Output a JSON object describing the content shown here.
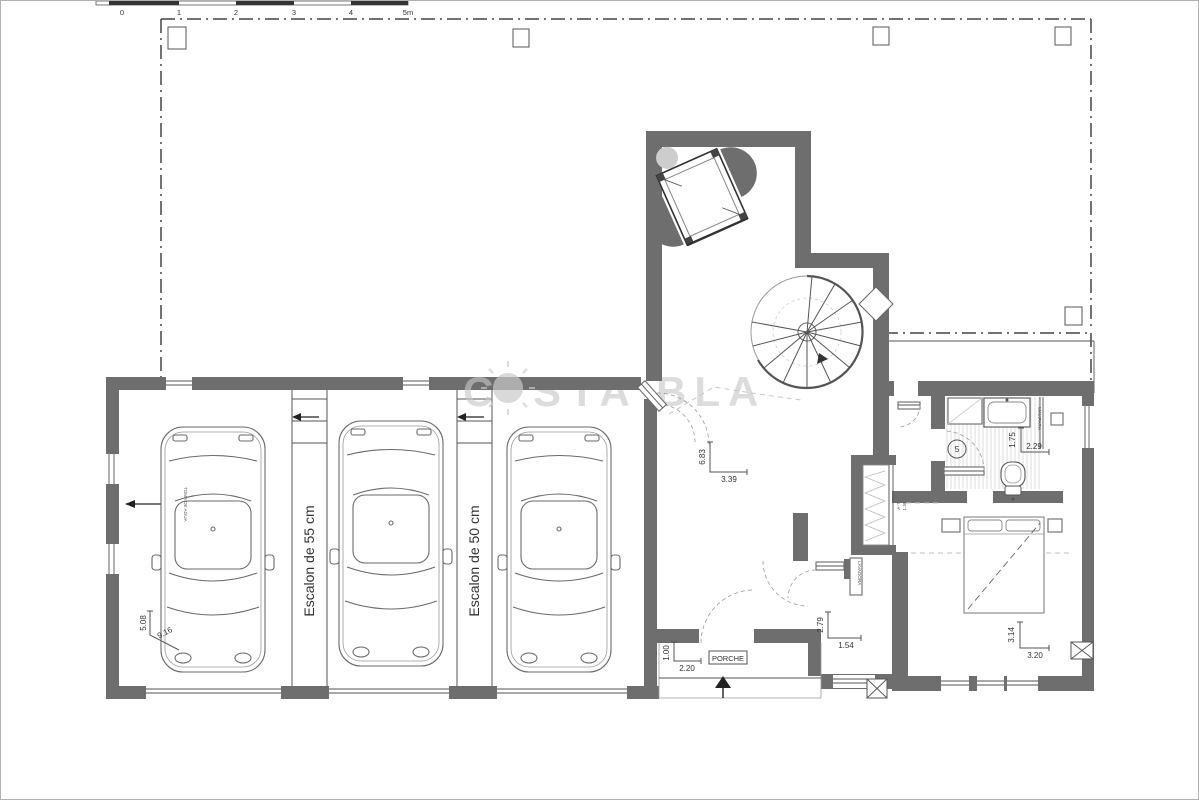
{
  "scale_bar": {
    "ticks": [
      "0",
      "1",
      "2",
      "3",
      "4",
      "5m"
    ]
  },
  "watermark": {
    "prefix": "C",
    "suffix": "STA BLA"
  },
  "labels": {
    "step_55": "Escalon de 55 cm",
    "step_50": "Escalon de 50 cm",
    "water_supply": "TOMA DE AGUA",
    "porch": "PORCHE",
    "shower_screen": "MAMPARA",
    "appliance": "LAVADORA",
    "bath_room_number": "5"
  },
  "dimensions": {
    "garage_width": "5.08",
    "garage_length": "9.16",
    "hall_length": "6.83",
    "hall_width": "3.39",
    "bath_length": "1.75",
    "bath_width": "2.29",
    "closet_ref": "A-7",
    "closet_width": "1.38",
    "vestibule_length": "2.79",
    "vestibule_width": "1.54",
    "porch_depth": "1.00",
    "porch_width": "2.20",
    "bedroom_length": "3.14",
    "bedroom_width": "3.20"
  },
  "colors": {
    "wall": "#6e6e6e"
  }
}
